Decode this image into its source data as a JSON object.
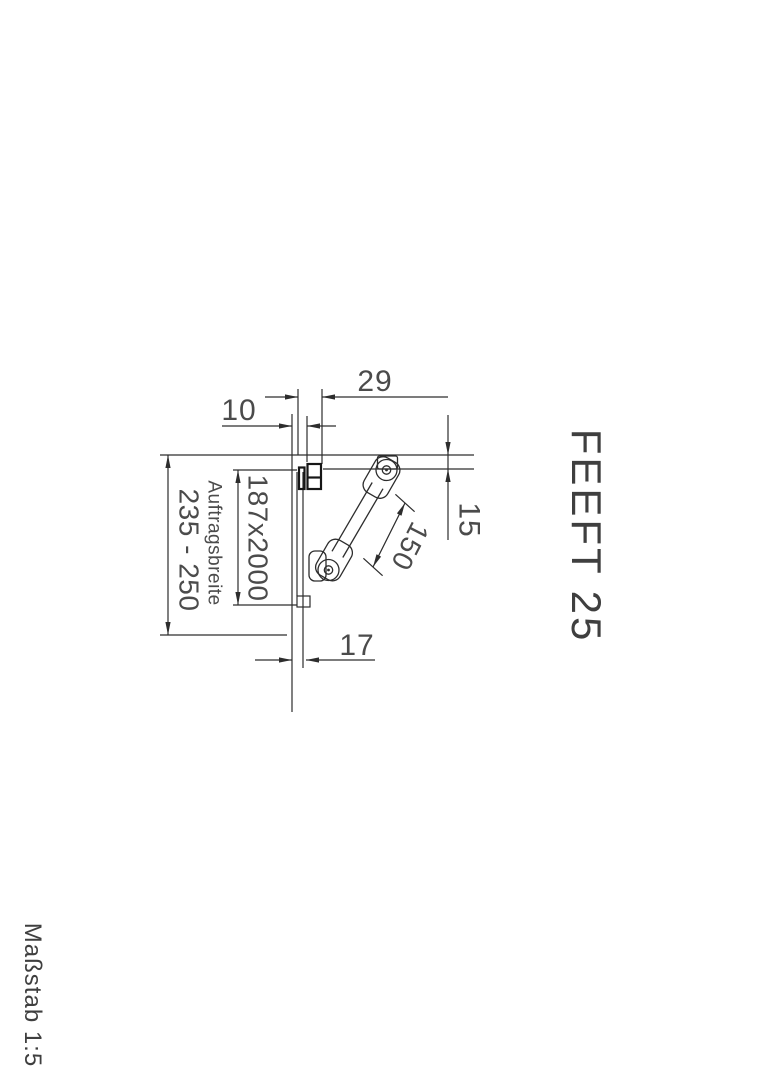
{
  "title_block": {
    "product_label": "FEEFT 25"
  },
  "footer": {
    "scale_label": "Maßstab 1:5"
  },
  "drawing": {
    "dimensions": {
      "bracket_width": "29",
      "profile_offset": "10",
      "top_drop": "15",
      "arm_length": "150",
      "bottom_offset": "17",
      "width_range": "235 - 250",
      "panel_size": "187x2000",
      "panel_label": "Auftragsbreite"
    },
    "colors": {
      "line": "#2d2d2d",
      "text": "#4b4b4b",
      "bracket": "#161616",
      "background": "#ffffff"
    }
  }
}
